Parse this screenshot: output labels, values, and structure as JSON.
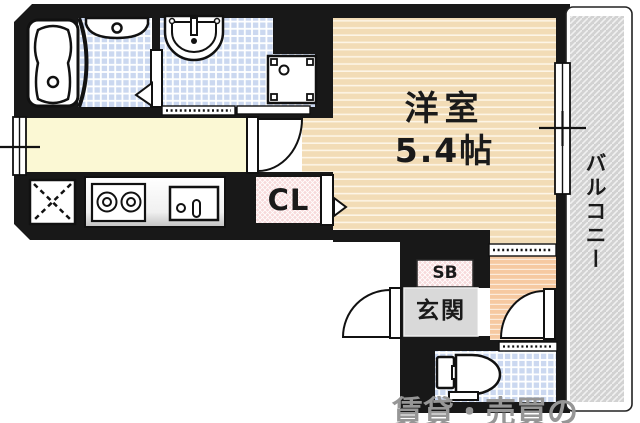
{
  "floor_plan": {
    "rooms": {
      "main_room": {
        "label": "洋室",
        "size": "5.4帖"
      },
      "closet": {
        "label": "CL"
      },
      "shoe_box": {
        "label": "SB"
      },
      "entrance": {
        "label": "玄関"
      },
      "balcony": {
        "label": "バルコニー"
      }
    },
    "watermark": {
      "text": "賃貸・売買の"
    },
    "fixture_icons": [
      "bathtub-icon",
      "bath-basin-icon",
      "vanity-sink-icon",
      "washing-machine-pan-icon",
      "refrigerator-space-icon",
      "gas-stove-icon",
      "kitchen-sink-icon",
      "toilet-icon",
      "door-swing-icon",
      "folding-door-icon",
      "window-icon"
    ],
    "colors": {
      "wall_black": "#181818",
      "room_floor_tan": "#f2dcb6",
      "kitchen_floor_yellow": "#fbf8d4",
      "tile_blue": "#cbd8f0",
      "hallway_floor_peach": "#f6c9a1",
      "balcony_hatch_gray": "#d2d2d2",
      "closet_pink": "#f7d9da",
      "entrance_gray": "#d9d9d9",
      "label_text": "#1a1a1a",
      "watermark_gray": "#969696"
    }
  }
}
